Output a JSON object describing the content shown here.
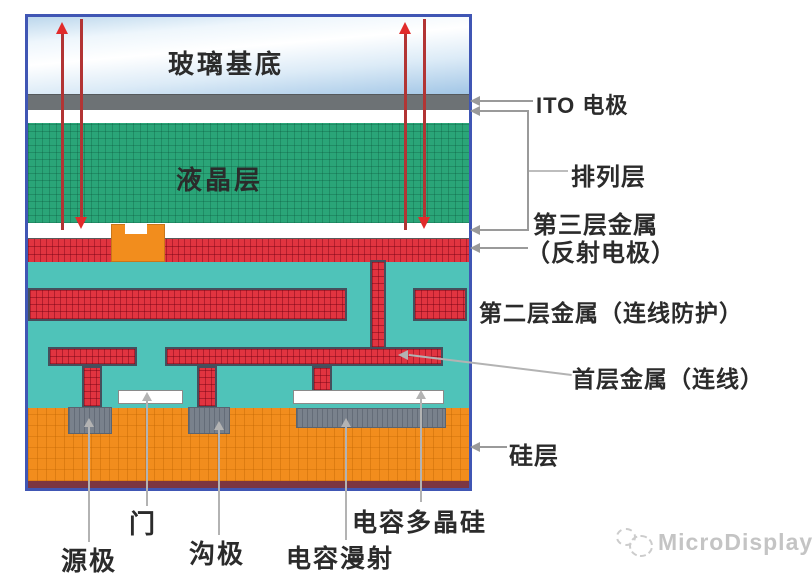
{
  "labels": {
    "glass": "玻璃基底",
    "liquid_crystal": "液晶层",
    "ito": "ITO 电极",
    "alignment": "排列层",
    "metal3_line1": "第三层金属",
    "metal3_line2": "（反射电极）",
    "metal2": "第二层金属（连线防护）",
    "metal1": "首层金属（连线）",
    "silicon": "硅层",
    "source": "源极",
    "gate": "门",
    "drain": "沟极",
    "cap_diffusion": "电容漫射",
    "cap_poly": "电容多晶硅"
  },
  "watermark": {
    "text": "MicroDisplay"
  },
  "colors": {
    "border": "#4056b4",
    "glass_blue": "#a2c6e6",
    "ito_gray": "#6d7275",
    "lc_green": "#2aa578",
    "metal_red": "#e13440",
    "insulator_teal": "#4fc3b9",
    "silicon_orange": "#f28d1d",
    "contact_gray": "#79818c",
    "substrate_maroon": "#7c3642",
    "arrow_red": "#e12b2b",
    "leader_gray": "#b3b3b3",
    "text_dark": "#2b2b2b",
    "watermark_gray": "#c4c4c4"
  }
}
